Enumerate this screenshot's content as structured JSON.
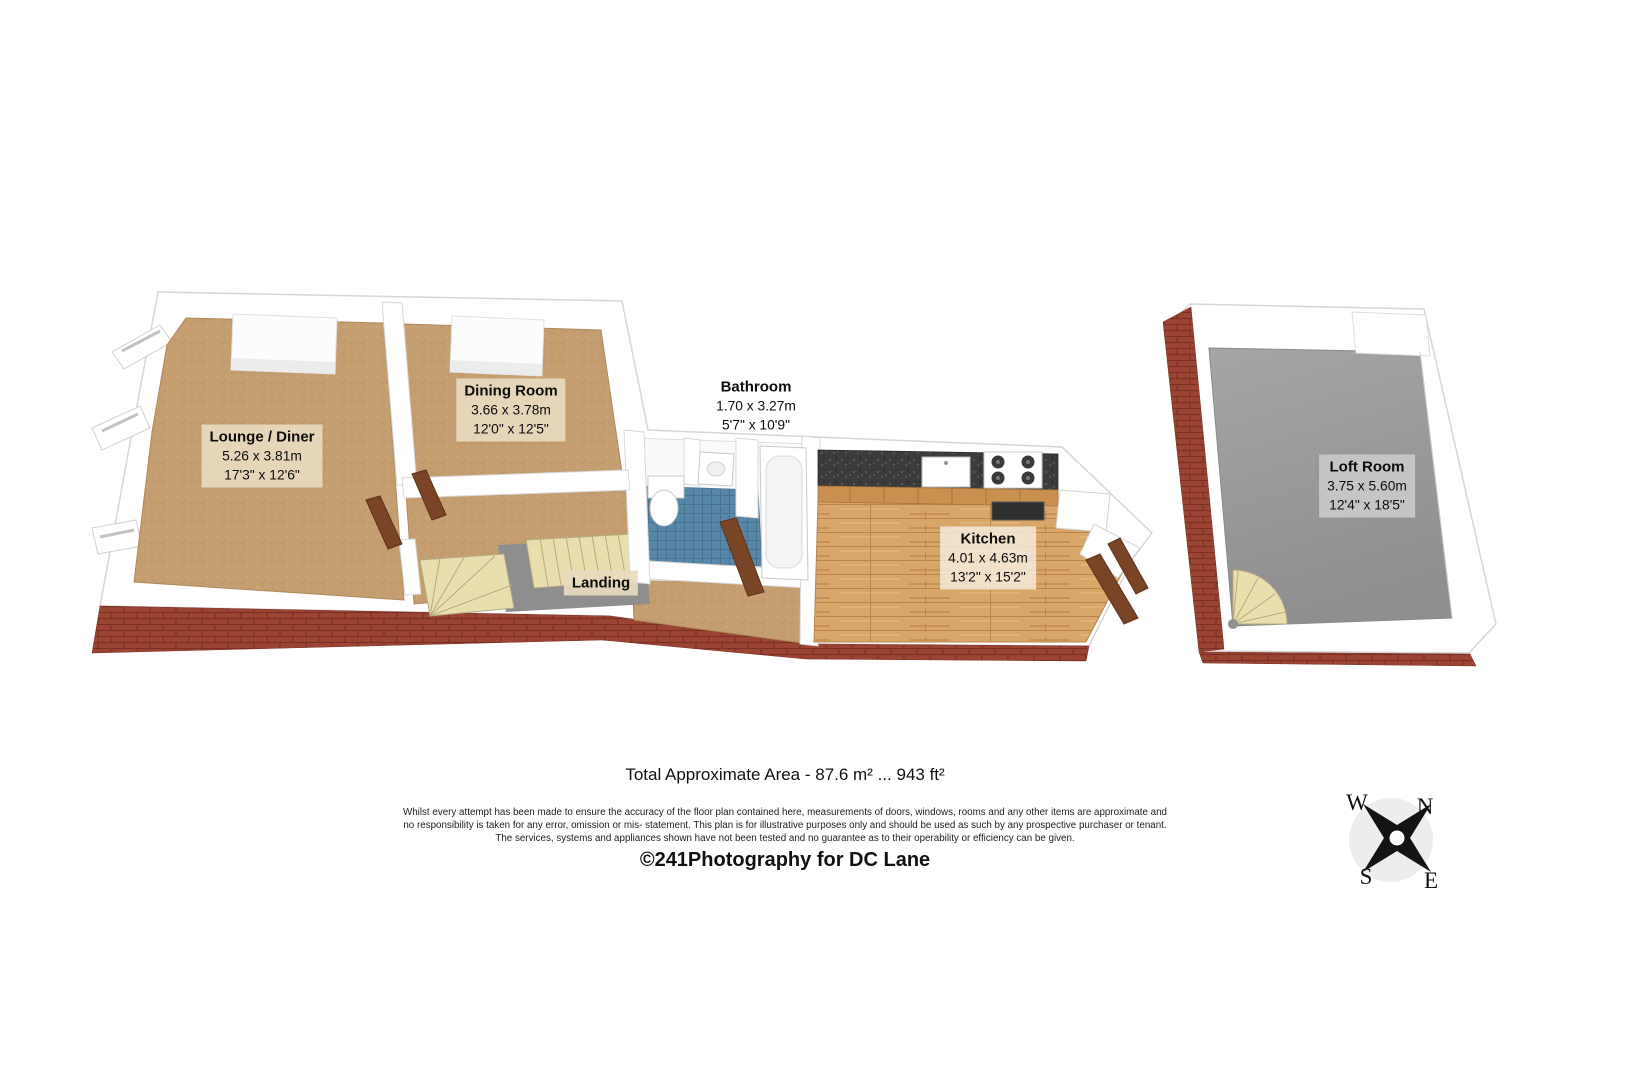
{
  "document": {
    "type": "3d-floorplan",
    "background": "#ffffff"
  },
  "rooms": [
    {
      "name": "Lounge / Diner",
      "metric": "5.26 x 3.81m",
      "imperial": "17'3\" x 12'6\""
    },
    {
      "name": "Dining Room",
      "metric": "3.66 x 3.78m",
      "imperial": "12'0\" x 12'5\""
    },
    {
      "name": "Bathroom",
      "metric": "1.70 x 3.27m",
      "imperial": "5'7\" x 10'9\""
    },
    {
      "name": "Kitchen",
      "metric": "4.01 x 4.63m",
      "imperial": "13'2\" x 15'2\""
    },
    {
      "name": "Landing"
    },
    {
      "name": "Loft Room",
      "metric": "3.75 x 5.60m",
      "imperial": "12'4\" x 18'5\""
    }
  ],
  "footer": {
    "total_area": "Total Approximate Area - 87.6 m² ... 943 ft²",
    "disclaimer_lines": [
      "Whilst every attempt has been made to ensure the accuracy of the floor plan contained here, measurements of doors, windows, rooms and any other items are approximate and",
      "no responsibility is taken for any error, omission or mis- statement.  This plan is for illustrative purposes only and should be used as such by any prospective purchaser or tenant.",
      "The services, systems and appliances shown have not been tested and no guarantee as to their operability or efficiency can be given."
    ],
    "credit": "©241Photography for DC Lane"
  },
  "compass": {
    "north": "N",
    "south": "S",
    "east": "E",
    "west": "W"
  },
  "colors": {
    "carpet": "#c49e70",
    "wood_floor": "#d8a668",
    "bathroom_tile": "#5886a8",
    "brick": "#9c4434",
    "loft_floor": "#9c9c9c",
    "counter_granite": "#3b3b3b",
    "stairs": "#e9dfae",
    "door_wood": "#7a4526",
    "wall": "#ffffff",
    "label_bg": "#e7dabf"
  }
}
